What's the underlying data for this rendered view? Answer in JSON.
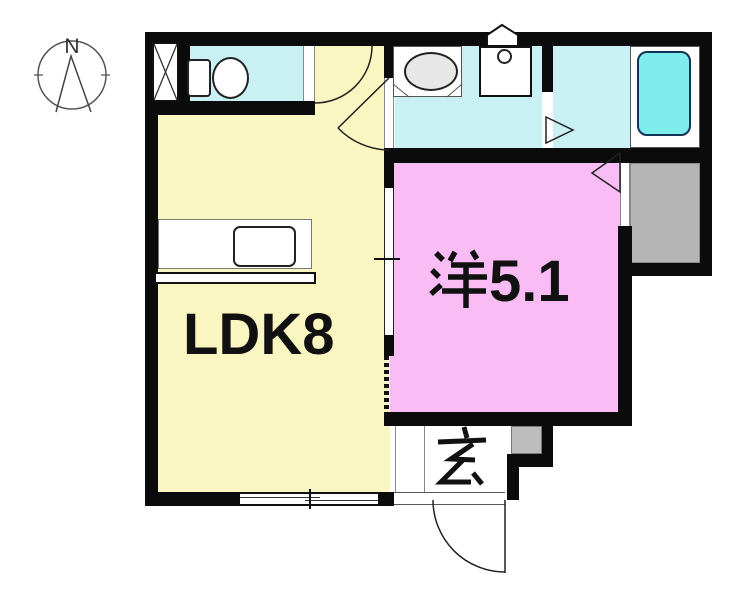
{
  "plan": {
    "title": "apartment-floor-plan",
    "compass": {
      "label": "N"
    },
    "rooms": {
      "ldk": {
        "label": "LDK8"
      },
      "western": {
        "label": "洋5.1",
        "kanji": "洋",
        "number": "5.1"
      },
      "genkan": {
        "label": "玄"
      }
    },
    "fixtures": [
      "compass",
      "closet-x",
      "toilet",
      "vanity-sink",
      "washing-machine-pan",
      "bathtub",
      "kitchen-counter",
      "sliding-door",
      "window",
      "entrance-door",
      "storage",
      "step-box",
      "door-swing-arc",
      "door-triangle-marker"
    ],
    "colors": {
      "wall": "#0b0b0b",
      "ldk": "#faf6c1",
      "wet": "#c9f1f3",
      "tub": "#7fedec",
      "bedroom": "#f9bcf4",
      "storage": "#b5b5b5",
      "step_box": "#bdbdbd",
      "sink": "#e7e7e7",
      "outline": "#1a1a1a"
    }
  }
}
